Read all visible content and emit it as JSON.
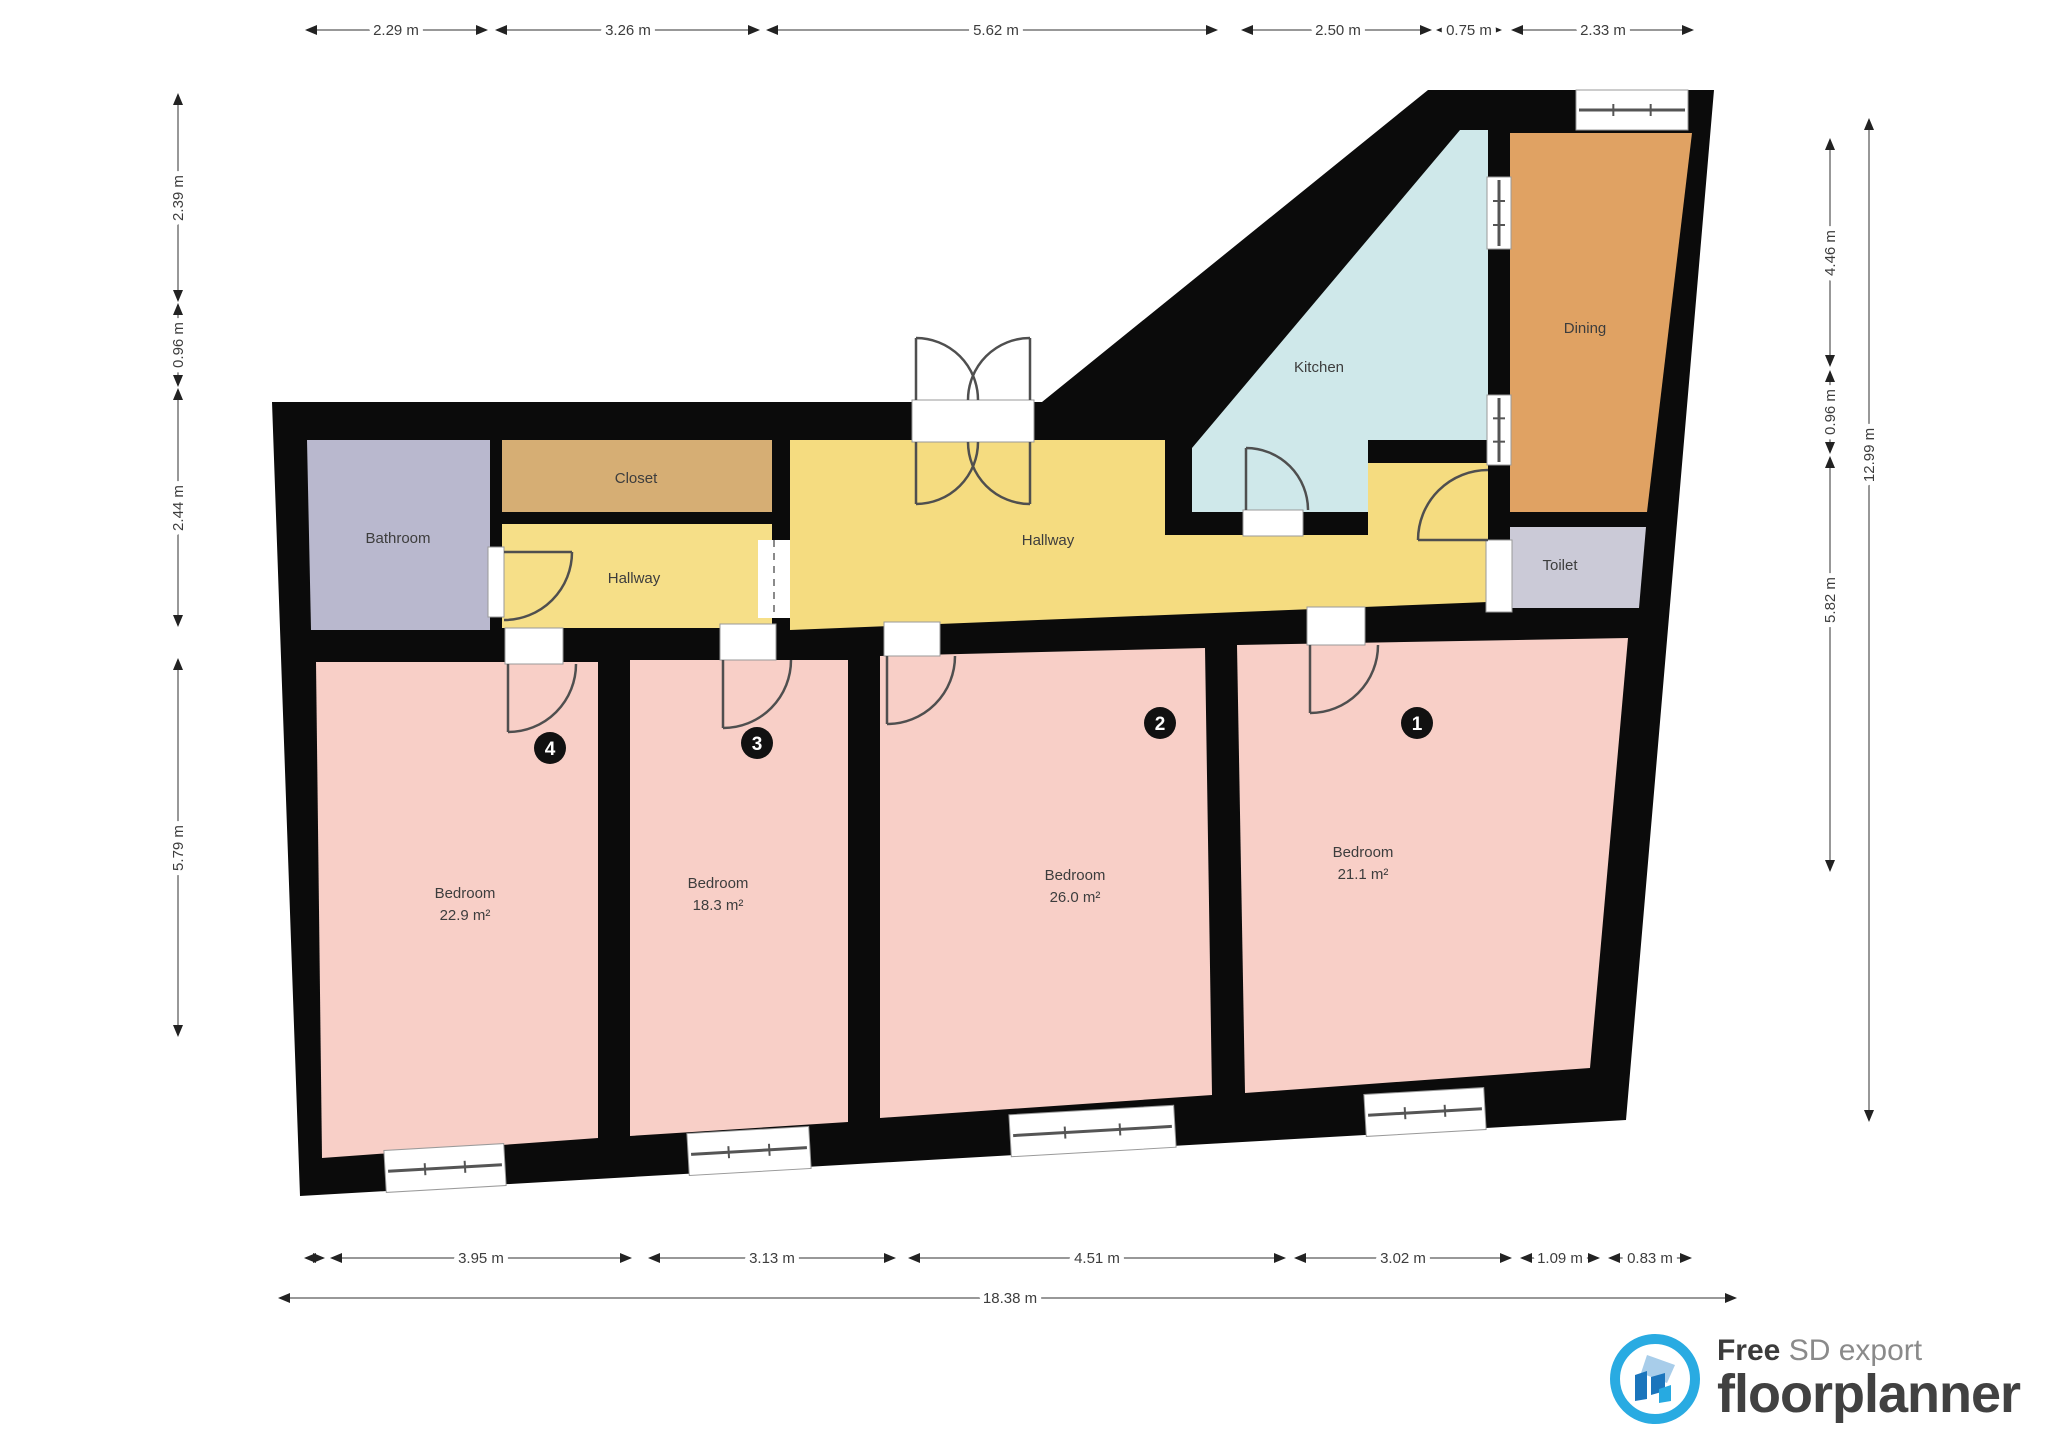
{
  "plan": {
    "wall_color": "#0b0b0b",
    "door_stroke": "#4f4f4f",
    "outline": [
      [
        272,
        402
      ],
      [
        1042,
        402
      ],
      [
        1428,
        90
      ],
      [
        1714,
        90
      ],
      [
        1626,
        1120
      ],
      [
        300,
        1196
      ]
    ],
    "rooms": [
      {
        "id": "bathroom",
        "label": "Bathroom",
        "area": "",
        "color": "#b9b8ce",
        "points": [
          [
            307,
            440
          ],
          [
            490,
            440
          ],
          [
            490,
            630
          ],
          [
            311,
            630
          ]
        ],
        "lx": 398,
        "ly": 543
      },
      {
        "id": "closet",
        "label": "Closet",
        "area": "",
        "color": "#d6ae74",
        "points": [
          [
            502,
            440
          ],
          [
            772,
            440
          ],
          [
            772,
            512
          ],
          [
            502,
            512
          ]
        ],
        "lx": 636,
        "ly": 483
      },
      {
        "id": "hallway-small",
        "label": "Hallway",
        "area": "",
        "color": "#f6df88",
        "points": [
          [
            502,
            524
          ],
          [
            772,
            524
          ],
          [
            772,
            628
          ],
          [
            502,
            628
          ]
        ],
        "lx": 634,
        "ly": 583
      },
      {
        "id": "hallway-main",
        "label": "Hallway",
        "area": "",
        "color": "#f5dc80",
        "points": [
          [
            790,
            440
          ],
          [
            1165,
            440
          ],
          [
            1165,
            535
          ],
          [
            1368,
            535
          ],
          [
            1368,
            463
          ],
          [
            1488,
            463
          ],
          [
            1488,
            602
          ],
          [
            790,
            630
          ]
        ],
        "lx": 1048,
        "ly": 545
      },
      {
        "id": "kitchen",
        "label": "Kitchen",
        "area": "",
        "color": "#cfe8ea",
        "points": [
          [
            1192,
            512
          ],
          [
            1192,
            448
          ],
          [
            1460,
            130
          ],
          [
            1488,
            130
          ],
          [
            1488,
            440
          ],
          [
            1368,
            440
          ],
          [
            1368,
            512
          ]
        ],
        "lx": 1319,
        "ly": 372
      },
      {
        "id": "dining",
        "label": "Dining",
        "area": "",
        "color": "#e0a263",
        "points": [
          [
            1510,
            133
          ],
          [
            1692,
            133
          ],
          [
            1647,
            512
          ],
          [
            1510,
            512
          ]
        ],
        "lx": 1585,
        "ly": 333
      },
      {
        "id": "toilet",
        "label": "Toilet",
        "area": "",
        "color": "#cbcad7",
        "points": [
          [
            1510,
            527
          ],
          [
            1646,
            527
          ],
          [
            1639,
            608
          ],
          [
            1510,
            608
          ]
        ],
        "lx": 1560,
        "ly": 570
      },
      {
        "id": "bedroom-4",
        "label": "Bedroom",
        "area": "22.9 m²",
        "color": "#f8cfc7",
        "points": [
          [
            316,
            662
          ],
          [
            598,
            662
          ],
          [
            598,
            1138
          ],
          [
            322,
            1158
          ]
        ],
        "lx": 465,
        "ly": 898
      },
      {
        "id": "bedroom-3",
        "label": "Bedroom",
        "area": "18.3 m²",
        "color": "#f8cfc7",
        "points": [
          [
            630,
            660
          ],
          [
            848,
            660
          ],
          [
            848,
            1122
          ],
          [
            630,
            1136
          ]
        ],
        "lx": 718,
        "ly": 888
      },
      {
        "id": "bedroom-2",
        "label": "Bedroom",
        "area": "26.0 m²",
        "color": "#f8cfc7",
        "points": [
          [
            880,
            656
          ],
          [
            1205,
            648
          ],
          [
            1212,
            1095
          ],
          [
            880,
            1118
          ]
        ],
        "lx": 1075,
        "ly": 880
      },
      {
        "id": "bedroom-1",
        "label": "Bedroom",
        "area": "21.1 m²",
        "color": "#f8cfc7",
        "points": [
          [
            1237,
            645
          ],
          [
            1628,
            638
          ],
          [
            1590,
            1068
          ],
          [
            1245,
            1093
          ]
        ],
        "lx": 1363,
        "ly": 857
      }
    ],
    "badges": [
      {
        "n": "4",
        "x": 550,
        "y": 748
      },
      {
        "n": "3",
        "x": 757,
        "y": 743
      },
      {
        "n": "2",
        "x": 1160,
        "y": 723
      },
      {
        "n": "1",
        "x": 1417,
        "y": 723
      }
    ],
    "doors": [
      {
        "id": "bathroom-door",
        "o": [
          488,
          547,
          16,
          70
        ],
        "d": "M504 552 L572 552 M572 552 A68 68 0 0 1 504 620"
      },
      {
        "id": "bedroom-4-door",
        "o": [
          505,
          628,
          58,
          36
        ],
        "d": "M508 664 L508 732 M576 664 A68 68 0 0 1 508 732"
      },
      {
        "id": "bedroom-3-door",
        "o": [
          720,
          624,
          56,
          36
        ],
        "d": "M723 660 L723 728 M791 660 A68 68 0 0 1 723 728"
      },
      {
        "id": "bedroom-2-door",
        "o": [
          884,
          622,
          56,
          34
        ],
        "d": "M887 656 L887 724 M955 656 A68 68 0 0 1 887 724"
      },
      {
        "id": "bedroom-1-door",
        "o": [
          1307,
          607,
          58,
          38
        ],
        "d": "M1310 645 L1310 713 M1378 645 A68 68 0 0 1 1310 713"
      },
      {
        "id": "kitchen-door",
        "o": [
          1243,
          510,
          60,
          26
        ],
        "d": "M1246 510 L1246 448 M1246 448 A62 62 0 0 1 1308 510"
      },
      {
        "id": "toilet-door",
        "o": [
          1486,
          540,
          26,
          72
        ],
        "d": "M1488 470 A70 70 0 0 0 1418 540 M1418 540 L1488 540"
      },
      {
        "id": "hallway-double-door",
        "o": [
          912,
          400,
          122,
          42
        ],
        "d": "M916 442 L916 504 M978 442 A62 62 0 0 1 916 504 M1030 442 L1030 504 M968 442 A62 62 0 0 0 1030 504 M916 400 L916 338 M978 400 A62 62 0 0 0 916 338 M1030 400 L1030 338 M968 400 A62 62 0 0 1 1030 338"
      }
    ],
    "windows": [
      {
        "id": "window-bedroom-4",
        "x": 385,
        "y": 1147,
        "w": 120,
        "h": 42,
        "rot": -3.3
      },
      {
        "id": "window-bedroom-3",
        "x": 688,
        "y": 1130,
        "w": 122,
        "h": 42,
        "rot": -3.3
      },
      {
        "id": "window-bedroom-2",
        "x": 1010,
        "y": 1110,
        "w": 165,
        "h": 42,
        "rot": -3.3
      },
      {
        "id": "window-bedroom-1",
        "x": 1365,
        "y": 1091,
        "w": 120,
        "h": 42,
        "rot": -3.3
      },
      {
        "id": "window-dining-top",
        "x": 1576,
        "y": 90,
        "w": 112,
        "h": 40,
        "rot": 0
      },
      {
        "id": "window-kitchen-wall-1",
        "x": 1487,
        "y": 177,
        "w": 24,
        "h": 72,
        "rot": 0
      },
      {
        "id": "window-kitchen-wall-2",
        "x": 1487,
        "y": 395,
        "w": 24,
        "h": 70,
        "rot": 0
      }
    ],
    "openings": [
      {
        "id": "hallway-passage",
        "x": 758,
        "y": 540,
        "w": 32,
        "h": 78
      }
    ]
  },
  "dimensions": {
    "top": [
      {
        "label": "2.29 m",
        "x1": 307,
        "y1": 30,
        "x2": 486,
        "y2": 30,
        "lx": 396,
        "ly": 30,
        "rot": 0
      },
      {
        "label": "3.26 m",
        "x1": 497,
        "y1": 30,
        "x2": 758,
        "y2": 30,
        "lx": 628,
        "ly": 30,
        "rot": 0
      },
      {
        "label": "5.62 m",
        "x1": 768,
        "y1": 30,
        "x2": 1216,
        "y2": 30,
        "lx": 996,
        "ly": 30,
        "rot": 0
      },
      {
        "label": "2.50 m",
        "x1": 1243,
        "y1": 30,
        "x2": 1430,
        "y2": 30,
        "lx": 1338,
        "ly": 30,
        "rot": 0
      },
      {
        "label": "0.75 m",
        "x1": 1438,
        "y1": 30,
        "x2": 1500,
        "y2": 30,
        "lx": 1469,
        "ly": 30,
        "rot": 0
      },
      {
        "label": "2.33 m",
        "x1": 1513,
        "y1": 30,
        "x2": 1692,
        "y2": 30,
        "lx": 1603,
        "ly": 30,
        "rot": 0
      }
    ],
    "left": [
      {
        "label": "2.39 m",
        "x1": 178,
        "y1": 95,
        "x2": 178,
        "y2": 300,
        "lx": 178,
        "ly": 198,
        "rot": -90
      },
      {
        "label": "0.96 m",
        "x1": 178,
        "y1": 305,
        "x2": 178,
        "y2": 385,
        "lx": 178,
        "ly": 345,
        "rot": -90
      },
      {
        "label": "2.44 m",
        "x1": 178,
        "y1": 390,
        "x2": 178,
        "y2": 625,
        "lx": 178,
        "ly": 508,
        "rot": -90
      },
      {
        "label": "5.79 m",
        "x1": 178,
        "y1": 660,
        "x2": 178,
        "y2": 1035,
        "lx": 178,
        "ly": 848,
        "rot": -90
      }
    ],
    "right": [
      {
        "label": "4.46 m",
        "x1": 1830,
        "y1": 140,
        "x2": 1830,
        "y2": 365,
        "lx": 1830,
        "ly": 253,
        "rot": -90
      },
      {
        "label": "0.96 m",
        "x1": 1830,
        "y1": 372,
        "x2": 1830,
        "y2": 452,
        "lx": 1830,
        "ly": 412,
        "rot": -90
      },
      {
        "label": "5.82 m",
        "x1": 1830,
        "y1": 458,
        "x2": 1830,
        "y2": 870,
        "lx": 1830,
        "ly": 600,
        "rot": -90
      },
      {
        "label": "12.99 m",
        "x1": 1869,
        "y1": 120,
        "x2": 1869,
        "y2": 1120,
        "lx": 1869,
        "ly": 455,
        "rot": -90
      }
    ],
    "bottom": [
      {
        "label": "",
        "x1": 306,
        "y1": 1258,
        "x2": 323,
        "y2": 1258,
        "lx": 0,
        "ly": 0,
        "rot": 0
      },
      {
        "label": "3.95 m",
        "x1": 332,
        "y1": 1258,
        "x2": 630,
        "y2": 1258,
        "lx": 481,
        "ly": 1258,
        "rot": 0
      },
      {
        "label": "3.13 m",
        "x1": 650,
        "y1": 1258,
        "x2": 894,
        "y2": 1258,
        "lx": 772,
        "ly": 1258,
        "rot": 0
      },
      {
        "label": "4.51 m",
        "x1": 910,
        "y1": 1258,
        "x2": 1284,
        "y2": 1258,
        "lx": 1097,
        "ly": 1258,
        "rot": 0
      },
      {
        "label": "3.02 m",
        "x1": 1296,
        "y1": 1258,
        "x2": 1510,
        "y2": 1258,
        "lx": 1403,
        "ly": 1258,
        "rot": 0
      },
      {
        "label": "1.09 m",
        "x1": 1522,
        "y1": 1258,
        "x2": 1598,
        "y2": 1258,
        "lx": 1560,
        "ly": 1258,
        "rot": 0
      },
      {
        "label": "0.83 m",
        "x1": 1610,
        "y1": 1258,
        "x2": 1690,
        "y2": 1258,
        "lx": 1650,
        "ly": 1258,
        "rot": 0
      },
      {
        "label": "18.38 m",
        "x1": 280,
        "y1": 1298,
        "x2": 1735,
        "y2": 1298,
        "lx": 1010,
        "ly": 1298,
        "rot": 0
      }
    ]
  },
  "footer": {
    "free_label": "Free",
    "export_label": " SD export",
    "brand": "floorplanner",
    "ring_color": "#29abe2",
    "roof_color": "#a8cdea",
    "body_color": "#1b75bc",
    "accent_color": "#27aae1"
  }
}
